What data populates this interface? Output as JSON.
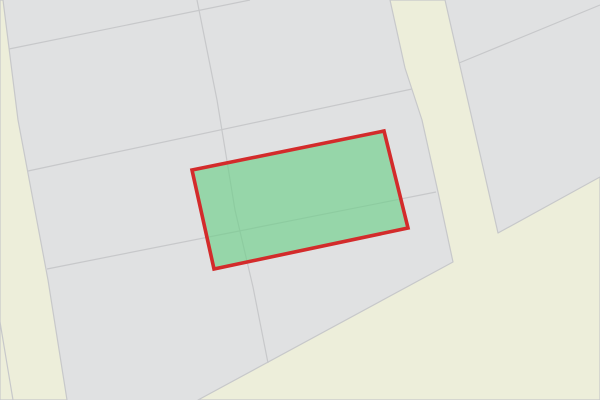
{
  "map": {
    "canvas": {
      "width": 600,
      "height": 400
    },
    "colors": {
      "background": "#e0e1e2",
      "boundary_line": "#c7c8ca",
      "road_fill": "#edeeda"
    },
    "boundary_width": 1.2,
    "roads": [
      {
        "id": "left-road",
        "points": [
          [
            3,
            0
          ],
          [
            18,
            120
          ],
          [
            48,
            280
          ],
          [
            67,
            400
          ],
          [
            0,
            400
          ],
          [
            0,
            0
          ]
        ]
      },
      {
        "id": "right-road-and-open-area",
        "points": [
          [
            390,
            0
          ],
          [
            445,
            0
          ],
          [
            498,
            233
          ],
          [
            600,
            177
          ],
          [
            600,
            400
          ],
          [
            198,
            400
          ],
          [
            453,
            262
          ],
          [
            438,
            192
          ],
          [
            422,
            120
          ],
          [
            405,
            68
          ]
        ]
      }
    ],
    "boundary_lines": [
      {
        "id": "parcel-line-top",
        "points": [
          [
            9,
            49
          ],
          [
            250,
            0
          ]
        ]
      },
      {
        "id": "parcel-line-middle",
        "points": [
          [
            28,
            171
          ],
          [
            412,
            89
          ]
        ]
      },
      {
        "id": "parcel-line-lower",
        "points": [
          [
            47,
            269
          ],
          [
            436,
            192
          ]
        ]
      },
      {
        "id": "parcel-line-vertical",
        "points": [
          [
            197,
            0
          ],
          [
            217,
            100
          ],
          [
            235,
            210
          ],
          [
            253,
            287
          ],
          [
            268,
            363
          ]
        ]
      },
      {
        "id": "parcel-line-right-of-road",
        "points": [
          [
            459,
            63
          ],
          [
            600,
            5
          ]
        ]
      },
      {
        "id": "parcel-line-in-left-road",
        "points": [
          [
            0,
            322
          ],
          [
            13,
            400
          ]
        ]
      }
    ],
    "selected_parcel": {
      "points": [
        [
          192,
          170
        ],
        [
          384,
          131
        ],
        [
          408,
          228
        ],
        [
          214,
          269
        ]
      ],
      "fill": "#69ce86",
      "fill_opacity": 0.62,
      "stroke": "#d32b2b",
      "stroke_width": 3.6
    }
  }
}
